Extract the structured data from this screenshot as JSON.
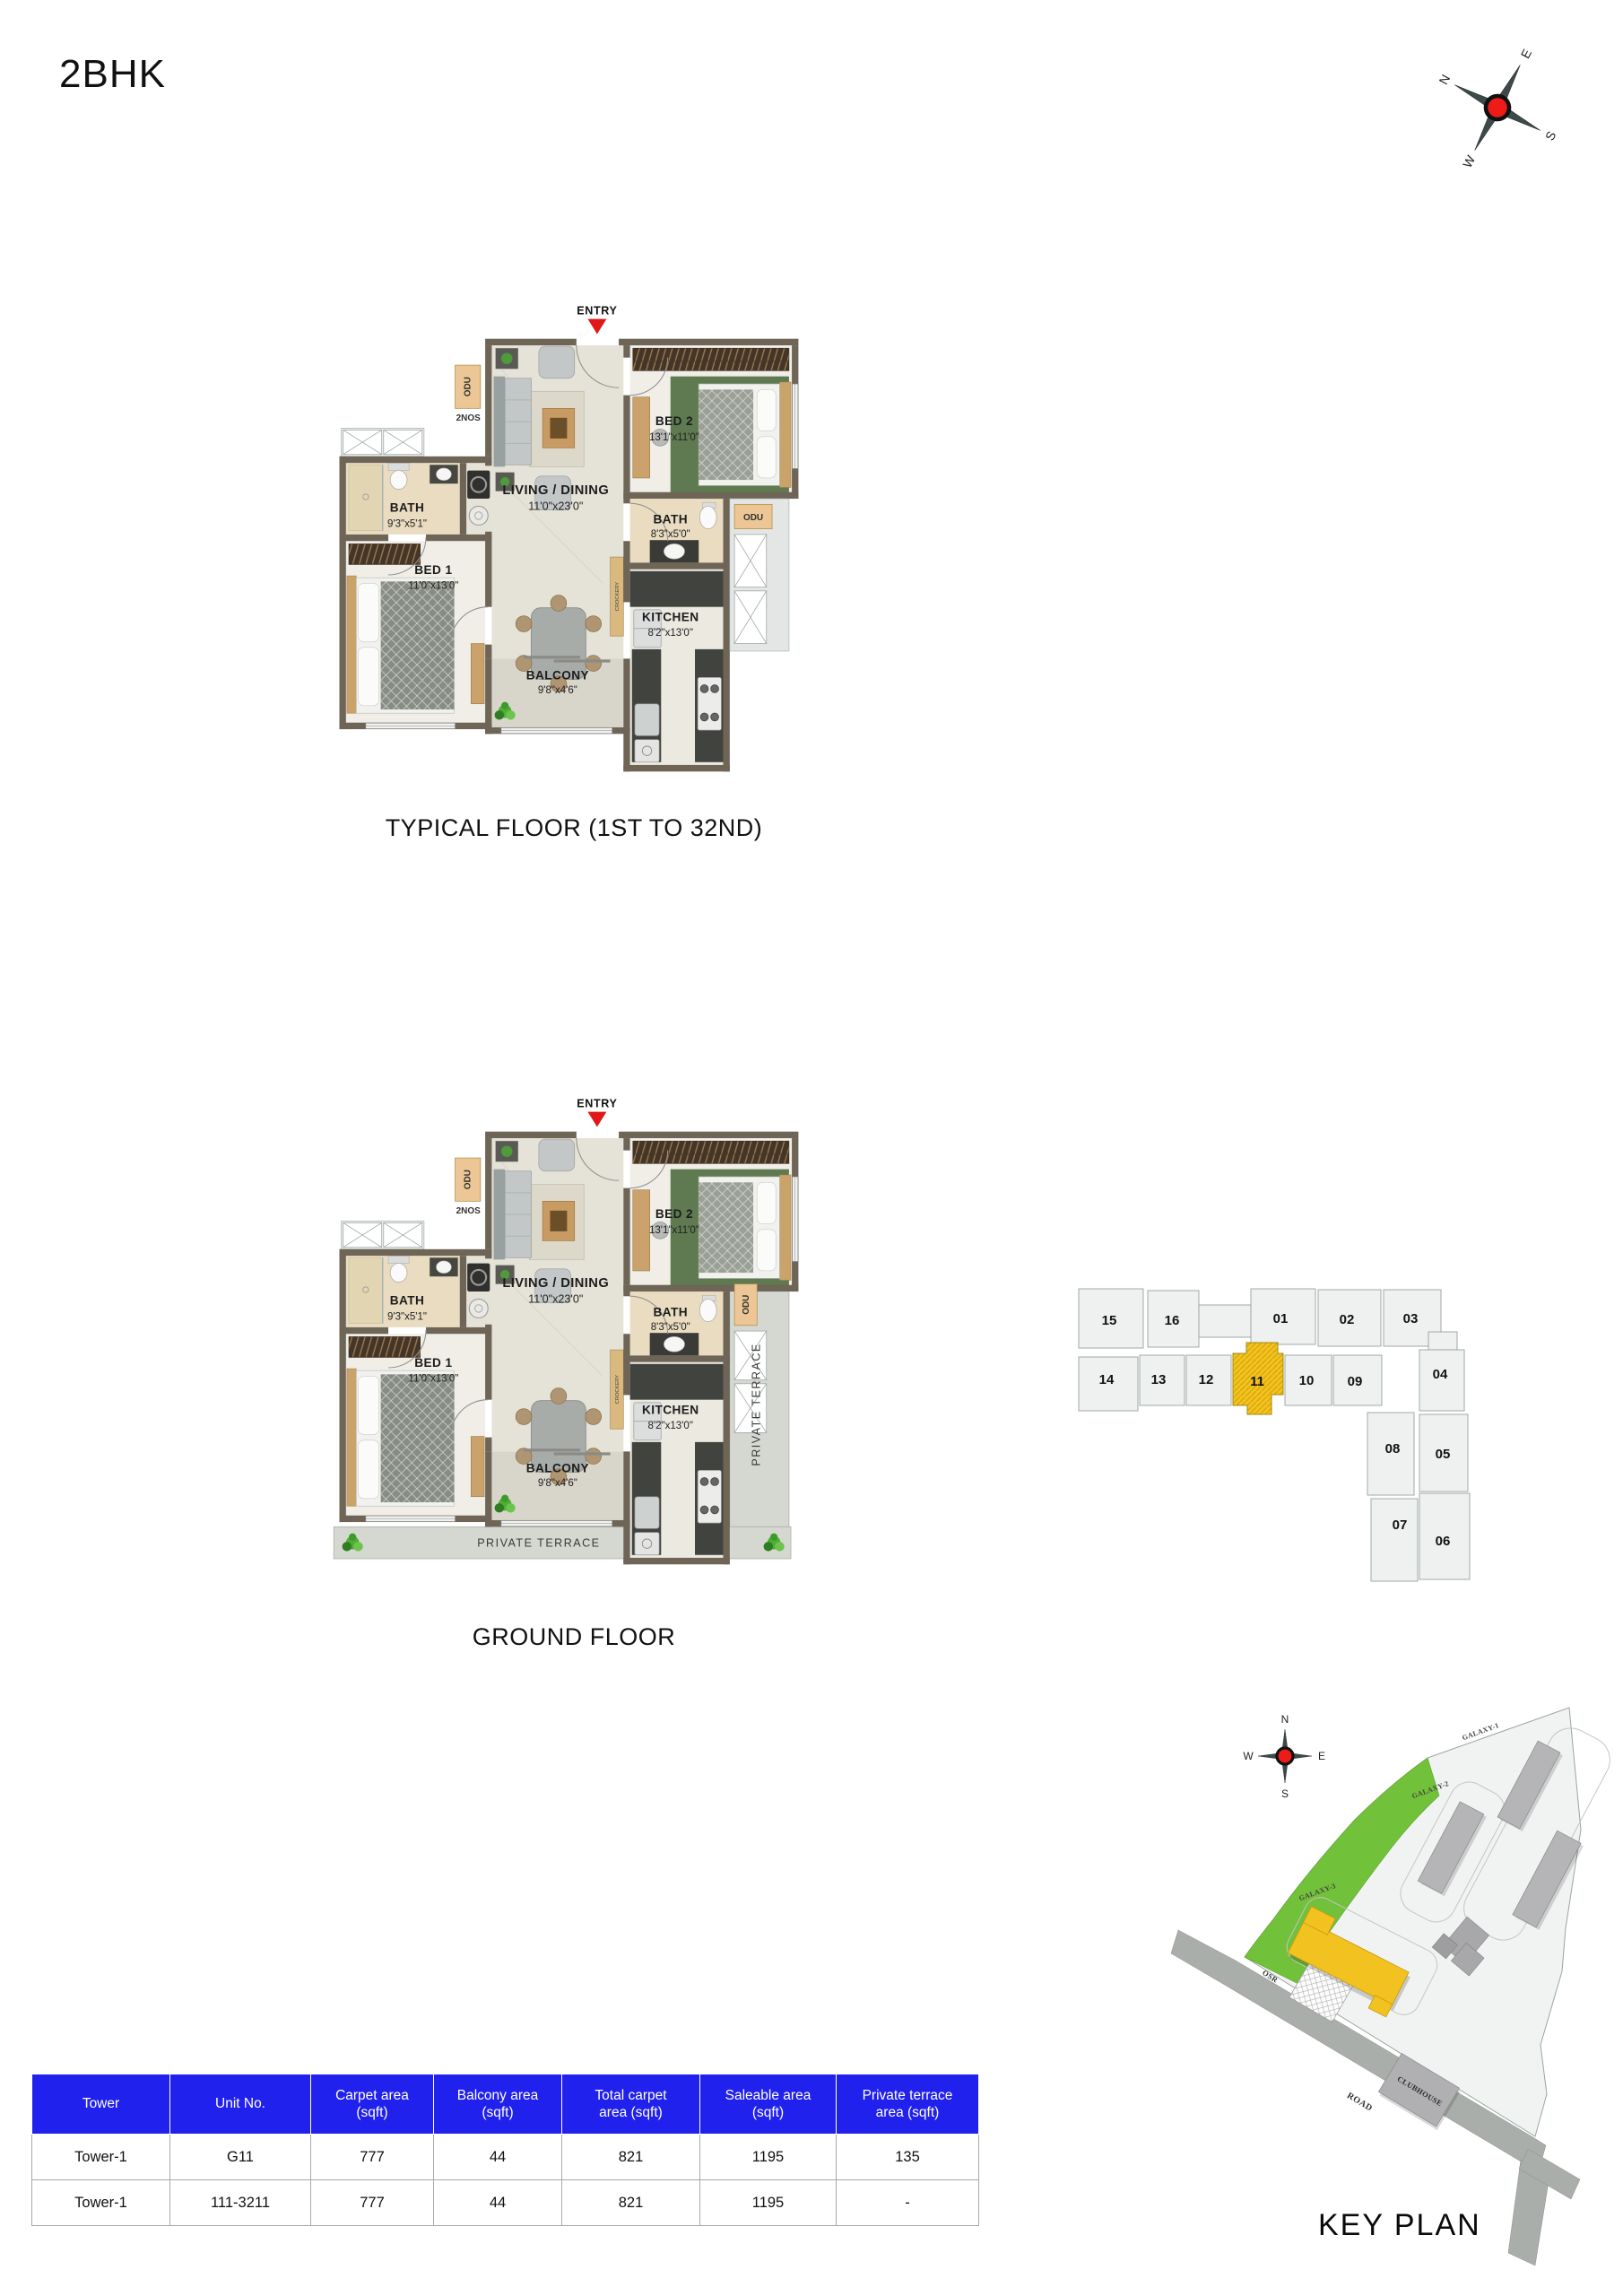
{
  "page": {
    "title": "2BHK"
  },
  "captions": {
    "typical": "TYPICAL FLOOR (1ST TO 32ND)",
    "ground": "GROUND FLOOR",
    "key_plan": "KEY PLAN"
  },
  "compass": {
    "n": "N",
    "e": "E",
    "s": "S",
    "w": "W"
  },
  "flat": {
    "entry": "ENTRY",
    "living": {
      "name": "LIVING / DINING",
      "dims": "11'0\"x23'0\""
    },
    "bed1": {
      "name": "BED 1",
      "dims": "11'0\"x13'0\""
    },
    "bed2": {
      "name": "BED 2",
      "dims": "13'1\"x11'0\""
    },
    "bath1": {
      "name": "BATH",
      "dims": "9'3\"x5'1\""
    },
    "bath2": {
      "name": "BATH",
      "dims": "8'3\"x5'0\""
    },
    "kitchen": {
      "name": "KITCHEN",
      "dims": "8'2\"x13'0\""
    },
    "balcony": {
      "name": "BALCONY",
      "dims": "9'8\"x4'6\""
    },
    "odu": "ODU",
    "two_nos": "2NOS",
    "crockery": "CROCKERY",
    "private_terrace": "PRIVATE TERRACE"
  },
  "unit_key_plan": {
    "units": [
      "15",
      "16",
      "01",
      "02",
      "03",
      "14",
      "13",
      "12",
      "11",
      "10",
      "09",
      "04",
      "08",
      "05",
      "07",
      "06"
    ],
    "highlighted_unit": "11"
  },
  "site_key_plan": {
    "labels": {
      "galaxy1": "GALAXY-1",
      "galaxy2": "GALAXY-2",
      "galaxy3": "GALAXY-3",
      "osr": "OSR",
      "road": "ROAD",
      "clubhouse": "CLUBHOUSE"
    }
  },
  "area_table": {
    "headers": [
      "Tower",
      "Unit No.",
      "Carpet area\n(sqft)",
      "Balcony area\n(sqft)",
      "Total carpet\narea (sqft)",
      "Saleable area\n(sqft)",
      "Private terrace\narea (sqft)"
    ],
    "rows": [
      [
        "Tower-1",
        "G11",
        "777",
        "44",
        "821",
        "1195",
        "135"
      ],
      [
        "Tower-1",
        "111-3211",
        "777",
        "44",
        "821",
        "1195",
        "-"
      ]
    ]
  },
  "colors": {
    "header_blue": "#2121ee",
    "highlight_yellow": "#f2c320",
    "osr_green": "#72c13a",
    "wall_taupe": "#6e6557",
    "entry_red": "#e01818"
  }
}
